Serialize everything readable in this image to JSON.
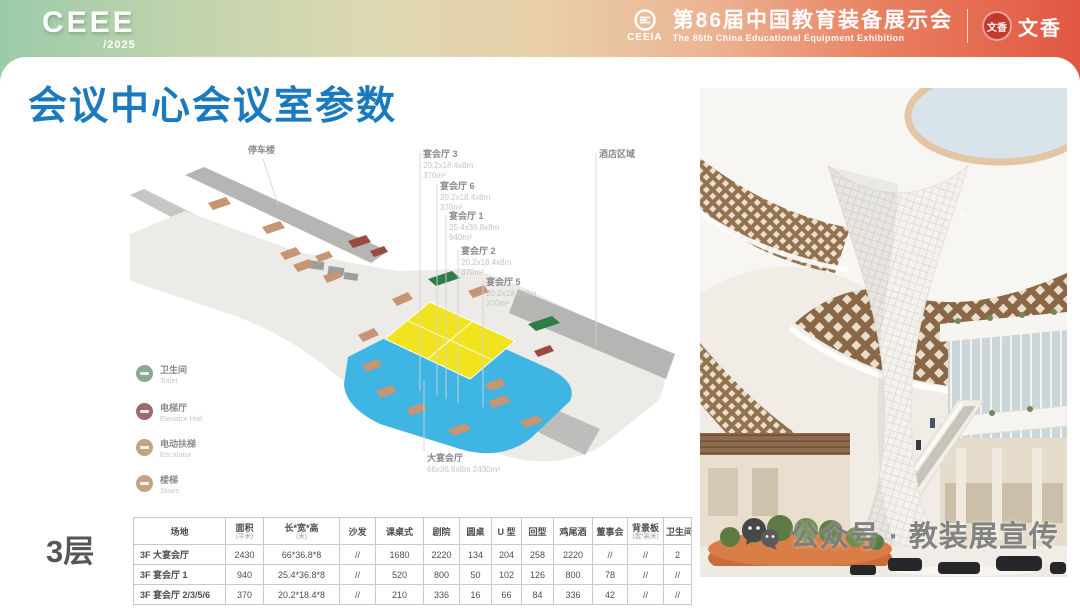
{
  "banner": {
    "logo": {
      "text": "CEEE",
      "year": "/2025"
    },
    "ceeia": {
      "abbr": "CEEIA",
      "title_cn": "第86届中国教育装备展示会",
      "title_en": "The 86th China Educational Equipment Exhibition"
    },
    "partner": {
      "seal": "文香",
      "name": "文香"
    }
  },
  "title": "会议中心会议室参数",
  "floor_label": "3层",
  "diagram": {
    "parking": "停车楼",
    "hotel_area": "酒店区域",
    "rooms": [
      {
        "name": "宴会厅 3",
        "dims": "20.2x18.4x8m",
        "area": "370m²"
      },
      {
        "name": "宴会厅 6",
        "dims": "20.2x18.4x8m",
        "area": "370m²"
      },
      {
        "name": "宴会厅 1",
        "dims": "25.4x36.8x8m",
        "area": "940m²"
      },
      {
        "name": "宴会厅 2",
        "dims": "20.2x18.4x8m",
        "area": "370m²"
      },
      {
        "name": "宴会厅 5",
        "dims": "20.2x18.4x8m",
        "area": "370m²"
      }
    ],
    "grand_hall": {
      "name": "大宴会厅",
      "dims": "66x36.8x8m  2430m²"
    },
    "legend": [
      {
        "cn": "卫生间",
        "en": "Toilet",
        "color": "#8aa98f"
      },
      {
        "cn": "电梯厅",
        "en": "Elevator Hall",
        "color": "#9c6b6b"
      },
      {
        "cn": "电动扶梯",
        "en": "Escalator",
        "color": "#c4a384"
      },
      {
        "cn": "楼梯",
        "en": "Stairs",
        "color": "#c4a384"
      }
    ],
    "colors": {
      "banquet_zone": "#3eb5e2",
      "grand_hall": "#f2e31f",
      "floor": "#ecebe8",
      "parking": "#b5b5b3"
    }
  },
  "table": {
    "headers": [
      {
        "label": "场地",
        "sub": ""
      },
      {
        "label": "面积",
        "sub": "(平米)"
      },
      {
        "label": "长*宽*高",
        "sub": "(米)"
      },
      {
        "label": "沙发",
        "sub": ""
      },
      {
        "label": "课桌式",
        "sub": ""
      },
      {
        "label": "剧院",
        "sub": ""
      },
      {
        "label": "圆桌",
        "sub": ""
      },
      {
        "label": "U 型",
        "sub": ""
      },
      {
        "label": "回型",
        "sub": ""
      },
      {
        "label": "鸡尾酒",
        "sub": ""
      },
      {
        "label": "董事会",
        "sub": ""
      },
      {
        "label": "背景板",
        "sub": "(宽*高米)"
      },
      {
        "label": "卫生间",
        "sub": ""
      }
    ],
    "rows": [
      [
        "3F 大宴会厅",
        "2430",
        "66*36.8*8",
        "//",
        "1680",
        "2220",
        "134",
        "204",
        "258",
        "2220",
        "//",
        "//",
        "2"
      ],
      [
        "3F 宴会厅 1",
        "940",
        "25.4*36.8*8",
        "//",
        "520",
        "800",
        "50",
        "102",
        "126",
        "800",
        "78",
        "//",
        "//"
      ],
      [
        "3F 宴会厅 2/3/5/6",
        "370",
        "20.2*18.4*8",
        "//",
        "210",
        "336",
        "16",
        "66",
        "84",
        "336",
        "42",
        "//",
        "//"
      ]
    ]
  },
  "photo": {
    "watermark": "公众号 · 教装展宣传"
  }
}
